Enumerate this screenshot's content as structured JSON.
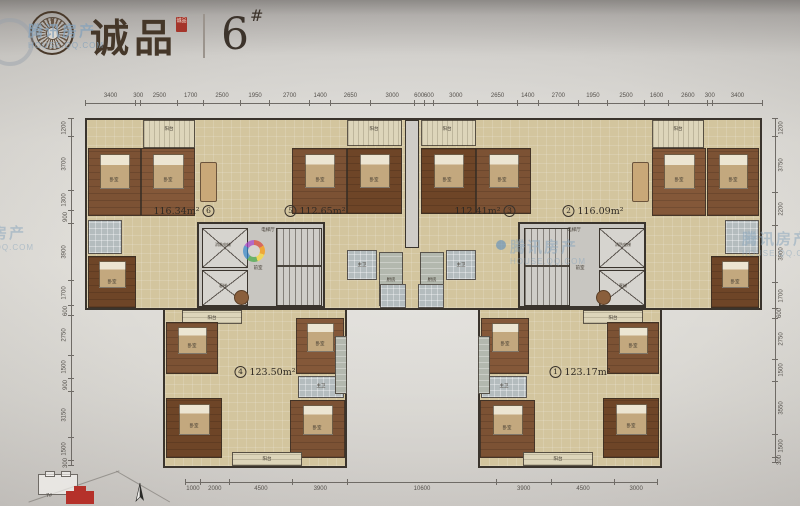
{
  "header": {
    "brand": "诚品",
    "seal_text": "诚品",
    "building_number": "6",
    "building_suffix": "#"
  },
  "watermark": {
    "cn": "腾讯房产",
    "en": "HOUSE.QQ.COM"
  },
  "units": [
    {
      "no": "6",
      "area": "116.34m²",
      "area_first": true
    },
    {
      "no": "5",
      "area": "112.65m²",
      "area_first": false
    },
    {
      "no": "3",
      "area": "112.41m²",
      "area_first": true
    },
    {
      "no": "2",
      "area": "116.09m²",
      "area_first": false
    },
    {
      "no": "4",
      "area": "123.50m²",
      "area_first": false
    },
    {
      "no": "1",
      "area": "123.17m²",
      "area_first": false
    }
  ],
  "room_labels": [
    {
      "text": "阳台",
      "x": 169,
      "y": 129,
      "s": 4.5
    },
    {
      "text": "阳台",
      "x": 374,
      "y": 129,
      "s": 4.5
    },
    {
      "text": "阳台",
      "x": 447,
      "y": 129,
      "s": 4.5
    },
    {
      "text": "阳台",
      "x": 678,
      "y": 129,
      "s": 4.5
    },
    {
      "text": "阳台",
      "x": 212,
      "y": 318,
      "s": 4.5
    },
    {
      "text": "阳台",
      "x": 613,
      "y": 318,
      "s": 4.5
    },
    {
      "text": "阳台",
      "x": 267,
      "y": 459,
      "s": 4.5
    },
    {
      "text": "阳台",
      "x": 558,
      "y": 459,
      "s": 4.5
    },
    {
      "text": "卧室",
      "x": 114,
      "y": 180,
      "s": 4.5
    },
    {
      "text": "卧室",
      "x": 168,
      "y": 180,
      "s": 4.5
    },
    {
      "text": "卧室",
      "x": 112,
      "y": 282,
      "s": 4.5
    },
    {
      "text": "卧室",
      "x": 320,
      "y": 180,
      "s": 4.5
    },
    {
      "text": "卧室",
      "x": 374,
      "y": 180,
      "s": 4.5
    },
    {
      "text": "卧室",
      "x": 447,
      "y": 180,
      "s": 4.5
    },
    {
      "text": "卧室",
      "x": 502,
      "y": 180,
      "s": 4.5
    },
    {
      "text": "卧室",
      "x": 679,
      "y": 180,
      "s": 4.5
    },
    {
      "text": "卧室",
      "x": 733,
      "y": 180,
      "s": 4.5
    },
    {
      "text": "卧室",
      "x": 735,
      "y": 282,
      "s": 4.5
    },
    {
      "text": "卧室",
      "x": 192,
      "y": 346,
      "s": 4.5
    },
    {
      "text": "卧室",
      "x": 320,
      "y": 344,
      "s": 4.5
    },
    {
      "text": "卧室",
      "x": 194,
      "y": 426,
      "s": 4.5
    },
    {
      "text": "卧室",
      "x": 317,
      "y": 428,
      "s": 4.5
    },
    {
      "text": "卧室",
      "x": 633,
      "y": 346,
      "s": 4.5
    },
    {
      "text": "卧室",
      "x": 505,
      "y": 344,
      "s": 4.5
    },
    {
      "text": "卧室",
      "x": 631,
      "y": 426,
      "s": 4.5
    },
    {
      "text": "卧室",
      "x": 507,
      "y": 428,
      "s": 4.5
    },
    {
      "text": "主卫",
      "x": 362,
      "y": 265,
      "s": 4.5
    },
    {
      "text": "主卫",
      "x": 461,
      "y": 265,
      "s": 4.5
    },
    {
      "text": "主卫",
      "x": 321,
      "y": 386,
      "s": 4.5
    },
    {
      "text": "主卫",
      "x": 504,
      "y": 386,
      "s": 4.5
    },
    {
      "text": "厨房",
      "x": 391,
      "y": 280,
      "s": 4.5
    },
    {
      "text": "厨房",
      "x": 432,
      "y": 280,
      "s": 4.5
    },
    {
      "text": "电梯厅",
      "x": 268,
      "y": 230,
      "s": 4.5
    },
    {
      "text": "电梯厅",
      "x": 574,
      "y": 230,
      "s": 4.5
    },
    {
      "text": "前室",
      "x": 258,
      "y": 268,
      "s": 4.5
    },
    {
      "text": "前室",
      "x": 580,
      "y": 268,
      "s": 4.5
    },
    {
      "text": "消防电梯",
      "x": 223,
      "y": 245,
      "s": 4
    },
    {
      "text": "消防电梯",
      "x": 623,
      "y": 245,
      "s": 4
    },
    {
      "text": "客梯",
      "x": 223,
      "y": 286,
      "s": 4
    },
    {
      "text": "客梯",
      "x": 623,
      "y": 286,
      "s": 4
    }
  ],
  "dimensions": {
    "top": [
      3400,
      300,
      2500,
      1700,
      2500,
      1950,
      2700,
      1400,
      2650,
      3000,
      600,
      600,
      3000,
      2650,
      1400,
      2700,
      1950,
      2500,
      1600,
      2600,
      300,
      3400
    ],
    "bottom": [
      1000,
      2000,
      4500,
      3900,
      10600,
      3900,
      4500,
      3000
    ],
    "left": [
      1200,
      3700,
      1300,
      900,
      3900,
      1700,
      600,
      2750,
      1500,
      900,
      3150,
      1500,
      300
    ],
    "right": [
      1200,
      3750,
      2200,
      3900,
      1700,
      600,
      2750,
      1500,
      3550,
      1500,
      300
    ]
  },
  "keyplan": {
    "neighbor_building": "7#"
  }
}
